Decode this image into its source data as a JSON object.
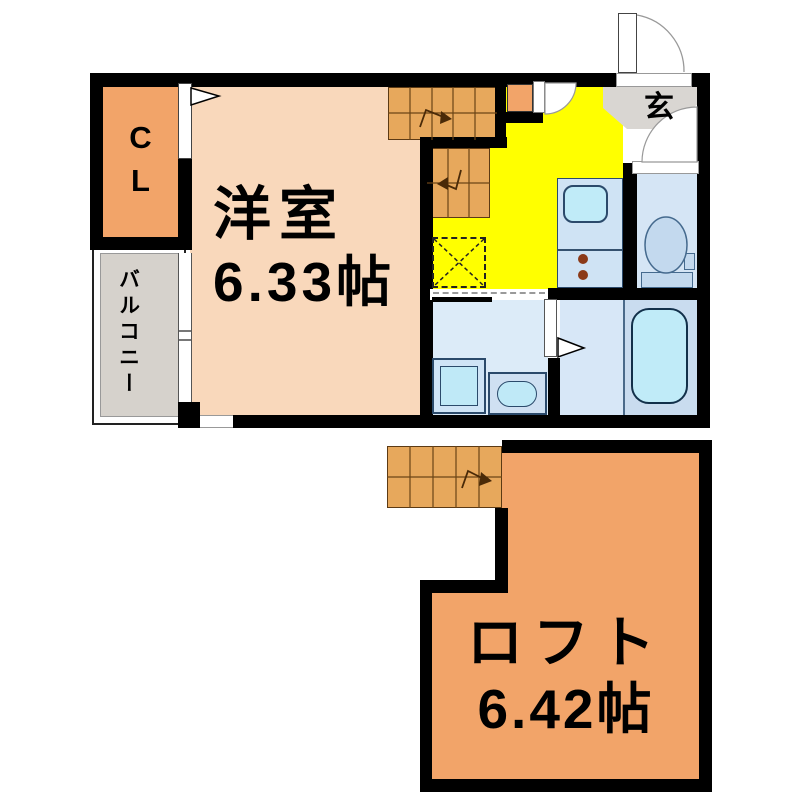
{
  "palette": {
    "wall_black": "#000000",
    "main_room_salmon": "#f9d8bb",
    "closet_loft_orange": "#f2a469",
    "stairs_tan": "#e7a85c",
    "kitchen_yellow": "#ffff00",
    "entrance_balcony_gray": "#d9d6d2",
    "water_area_blue": "#dcebf8",
    "counter_blue": "#cfe3f4",
    "bath_blue": "#c9dcef",
    "fixture_cyan": "#c0ebf8",
    "burner_brown": "#8b3a18"
  },
  "upper_floor": {
    "rooms": {
      "main_room": {
        "name": "洋室",
        "size": "6.33帖"
      },
      "closet": {
        "label": "CL"
      },
      "balcony": {
        "label": "バルコニー"
      },
      "entrance": {
        "label": "玄"
      }
    },
    "fixtures": [
      "staircase-upper",
      "staircase-lower",
      "refrigerator-space",
      "kitchen-counter",
      "kitchen-sink",
      "stove-burners",
      "toilet",
      "washing-machine",
      "vanity-sink",
      "bathtub",
      "entrance-door",
      "interior-doors",
      "closet-door",
      "balcony-window"
    ]
  },
  "lower_floor": {
    "rooms": {
      "loft": {
        "name": "ロフト",
        "size": "6.42帖"
      }
    },
    "fixtures": [
      "staircase"
    ]
  }
}
